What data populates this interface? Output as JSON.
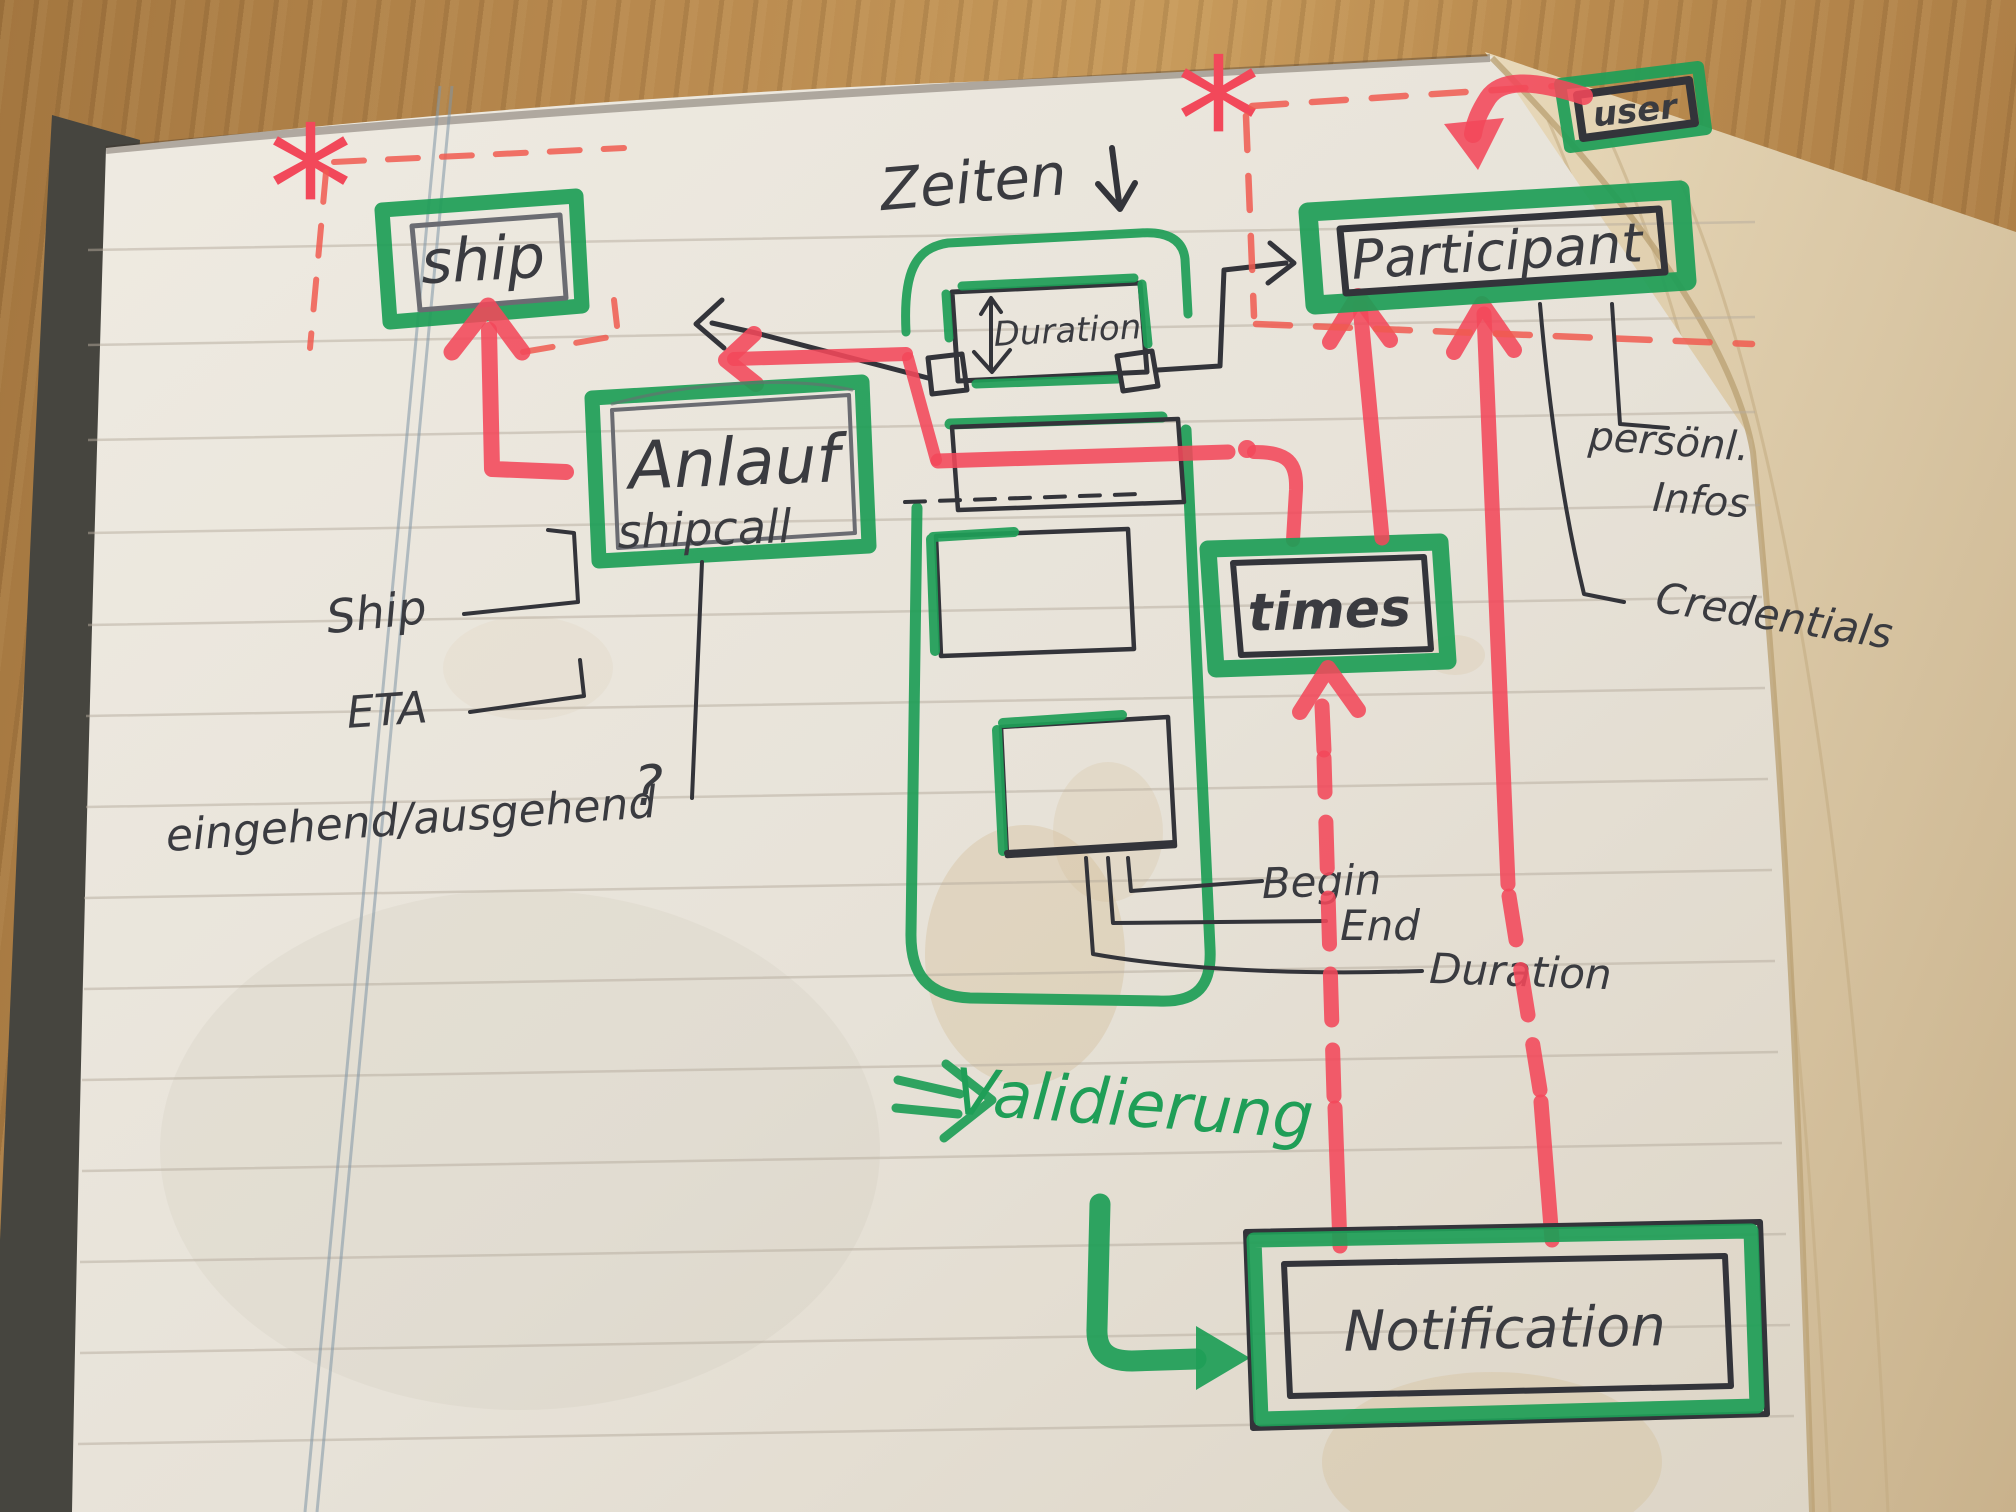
{
  "diagram": {
    "annotations": {
      "zeiten": "Zeiten",
      "validierung": "Validierung",
      "asterisk_ship": "*",
      "asterisk_participant": "*",
      "question_mark": "?"
    },
    "boxes": {
      "ship": "ship",
      "anlauf_line1": "Anlauf",
      "anlauf_line2": "shipcall",
      "duration": "Duration",
      "participant": "Participant",
      "user": "user",
      "times": "times",
      "notification": "Notification"
    },
    "attributes": {
      "ship": "Ship",
      "eta": "ETA",
      "in_out": "eingehend/ausgehend",
      "begin": "Begin",
      "end": "End",
      "duration": "Duration",
      "personal_line1": "persönl.",
      "personal_line2": "Infos",
      "credentials": "Credentials"
    },
    "colors": {
      "marker_green": "#1f9e57",
      "marker_red": "#f2485a",
      "dashed_red": "#f05a50",
      "pen_black": "#33343a",
      "pencil_gray": "#6b6c72"
    }
  }
}
